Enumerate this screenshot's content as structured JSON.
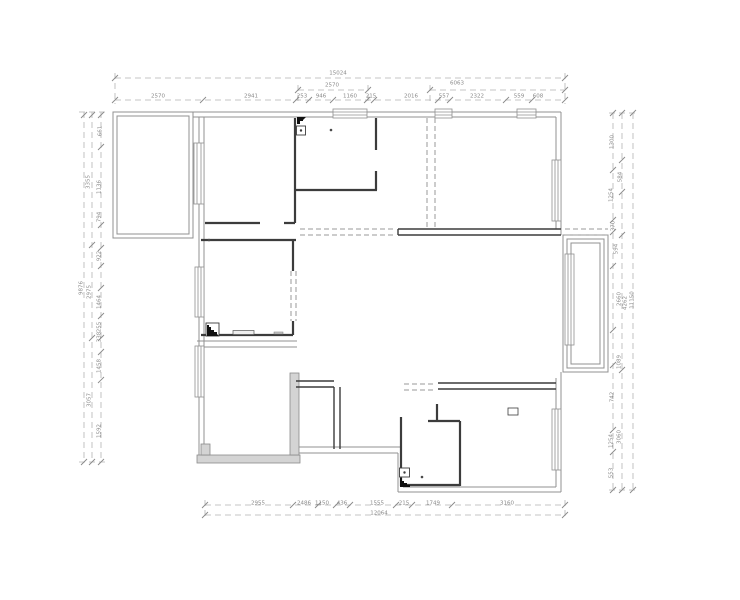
{
  "drawing": {
    "kind": "architectural floor plan, CAD line drawing",
    "rooms_visible": 9,
    "title": ""
  },
  "colors": {
    "background": "#ffffff",
    "exterior_wall": "#909090",
    "interior_wall": "#3c3c3c",
    "gray_wall_fill": "#d4d4d4",
    "dimension_line": "#b4b4b4",
    "dimension_text": "#8a8a8a",
    "symbol_black": "#111111"
  },
  "symbols": [
    {
      "name": "flue-shaft-symbol",
      "location": "kitchen top-left"
    },
    {
      "name": "flue-shaft-symbol",
      "location": "left bedroom bottom-left"
    },
    {
      "name": "flue-shaft-symbol",
      "location": "bathroom bottom-left"
    },
    {
      "name": "window-hatch",
      "count": 9
    },
    {
      "name": "cased-opening-dashed",
      "count": 5
    }
  ],
  "dim_labels": [
    {
      "t": "15024",
      "x": 338,
      "y": 74
    },
    {
      "t": "2570",
      "x": 332,
      "y": 86
    },
    {
      "t": "6063",
      "x": 457,
      "y": 84
    },
    {
      "t": "2570",
      "x": 158,
      "y": 97
    },
    {
      "t": "2941",
      "x": 251,
      "y": 97
    },
    {
      "t": "253",
      "x": 302,
      "y": 97
    },
    {
      "t": "946",
      "x": 321,
      "y": 97
    },
    {
      "t": "1160",
      "x": 350,
      "y": 97
    },
    {
      "t": "215",
      "x": 371,
      "y": 97
    },
    {
      "t": "2016",
      "x": 411,
      "y": 97
    },
    {
      "t": "557",
      "x": 444,
      "y": 97
    },
    {
      "t": "2322",
      "x": 477,
      "y": 97
    },
    {
      "t": "559",
      "x": 519,
      "y": 97
    },
    {
      "t": "608",
      "x": 538,
      "y": 97
    },
    {
      "t": "2955",
      "x": 258,
      "y": 504
    },
    {
      "t": "2486",
      "x": 304,
      "y": 504
    },
    {
      "t": "1150",
      "x": 322,
      "y": 504
    },
    {
      "t": "436",
      "x": 342,
      "y": 504
    },
    {
      "t": "1555",
      "x": 377,
      "y": 504
    },
    {
      "t": "215",
      "x": 404,
      "y": 504
    },
    {
      "t": "1749",
      "x": 433,
      "y": 504
    },
    {
      "t": "3160",
      "x": 507,
      "y": 504
    },
    {
      "t": "12064",
      "x": 379,
      "y": 514
    },
    {
      "t": "661",
      "x": 101,
      "y": 131,
      "r": -90
    },
    {
      "t": "3355",
      "x": 89,
      "y": 182,
      "r": -90
    },
    {
      "t": "1136",
      "x": 100,
      "y": 187,
      "r": -90
    },
    {
      "t": "794",
      "x": 100,
      "y": 217,
      "r": -90
    },
    {
      "t": "922",
      "x": 100,
      "y": 256,
      "r": -90
    },
    {
      "t": "9876",
      "x": 82,
      "y": 288,
      "r": -90
    },
    {
      "t": "2975",
      "x": 90,
      "y": 292,
      "r": -90
    },
    {
      "t": "1464",
      "x": 100,
      "y": 302,
      "r": -90
    },
    {
      "t": "255",
      "x": 100,
      "y": 327,
      "r": -90
    },
    {
      "t": "338",
      "x": 100,
      "y": 337,
      "r": -90
    },
    {
      "t": "1458",
      "x": 100,
      "y": 366,
      "r": -90
    },
    {
      "t": "3057",
      "x": 90,
      "y": 400,
      "r": -90
    },
    {
      "t": "1592",
      "x": 100,
      "y": 431,
      "r": -90
    },
    {
      "t": "1300",
      "x": 613,
      "y": 142,
      "r": -90
    },
    {
      "t": "584",
      "x": 621,
      "y": 177,
      "r": -90
    },
    {
      "t": "1254",
      "x": 612,
      "y": 195,
      "r": -90
    },
    {
      "t": "370",
      "x": 614,
      "y": 226,
      "r": -90
    },
    {
      "t": "594",
      "x": 617,
      "y": 249,
      "r": -90
    },
    {
      "t": "2660",
      "x": 620,
      "y": 299,
      "r": -90
    },
    {
      "t": "4262",
      "x": 626,
      "y": 303,
      "r": -90
    },
    {
      "t": "11150",
      "x": 633,
      "y": 300,
      "r": -90
    },
    {
      "t": "1089",
      "x": 620,
      "y": 362,
      "r": -90
    },
    {
      "t": "742",
      "x": 613,
      "y": 397,
      "r": -90
    },
    {
      "t": "3060",
      "x": 620,
      "y": 437,
      "r": -90
    },
    {
      "t": "1254",
      "x": 612,
      "y": 441,
      "r": -90
    },
    {
      "t": "553",
      "x": 612,
      "y": 473,
      "r": -90
    }
  ]
}
